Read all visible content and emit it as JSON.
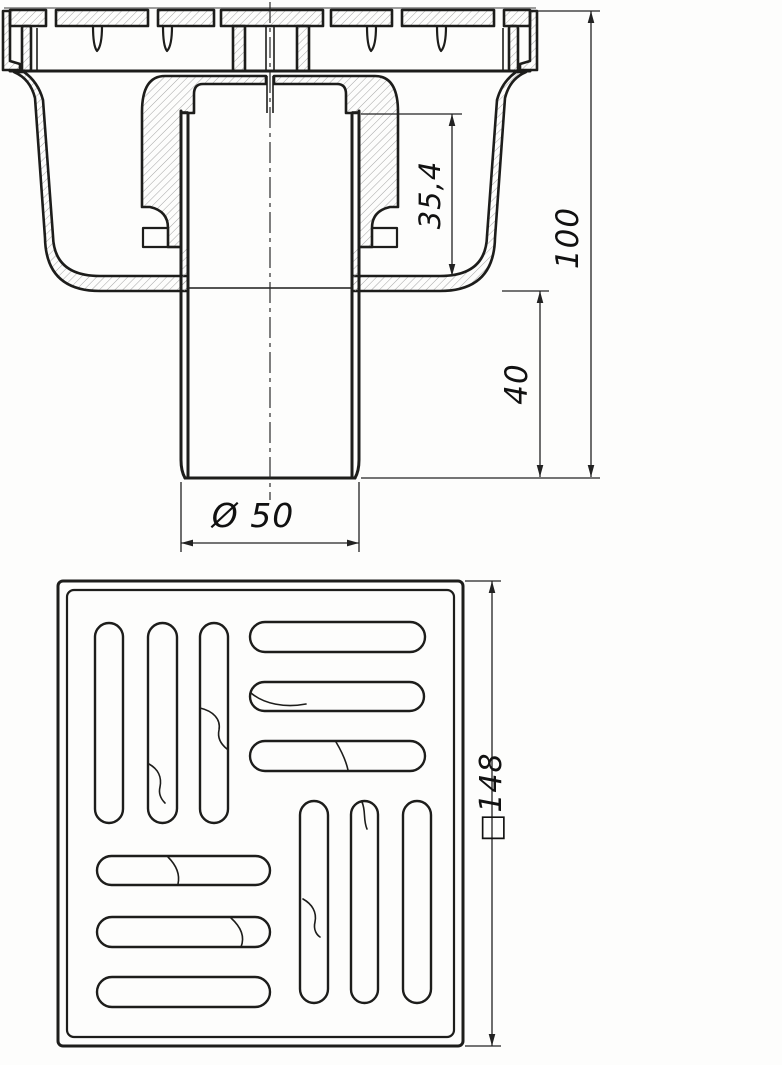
{
  "drawing": {
    "description": "Technical drawing of a floor drain: front section view (top) and grate plan view (bottom)",
    "colors": {
      "background": "#fdfdfc",
      "outline": "#1d1d1b",
      "dimension_line": "#222222",
      "hatch": "#9b9b9b"
    },
    "section_view": {
      "label": "front-section-view",
      "dimensions": {
        "seal_depth": "35,4",
        "overall_height": "100",
        "outlet_length": "40",
        "outlet_diameter": "Ø 50"
      }
    },
    "plan_view": {
      "label": "grate-plan-view",
      "dimensions": {
        "grate_size": "□148"
      }
    }
  }
}
